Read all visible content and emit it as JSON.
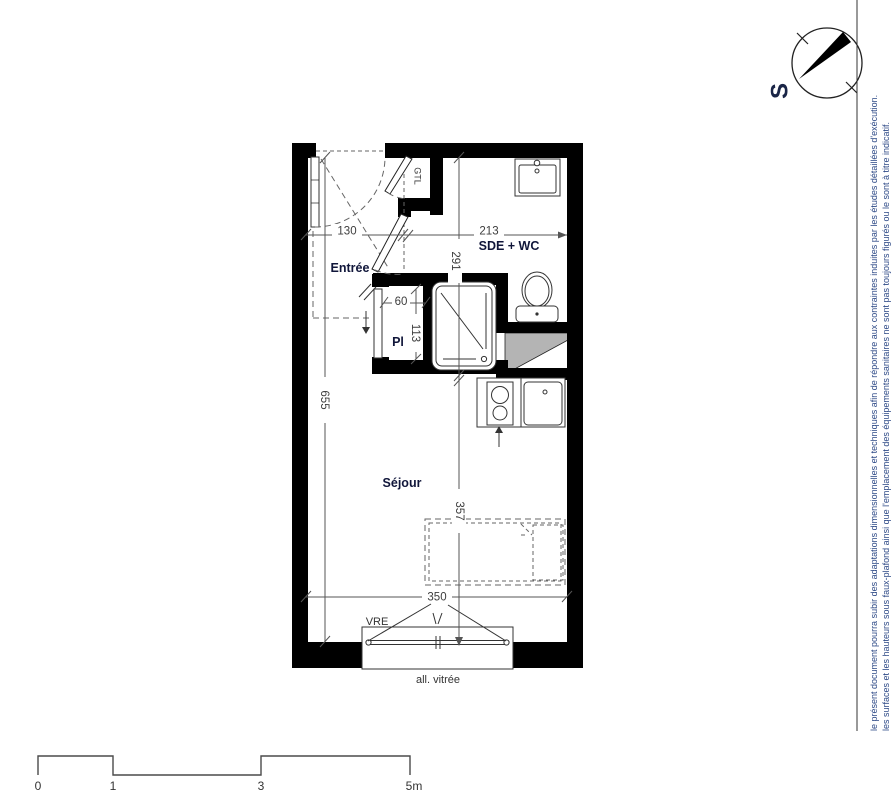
{
  "plan": {
    "rooms": {
      "entree": "Entrée",
      "sde_wc": "SDE + WC",
      "sejour": "Séjour",
      "placard": "Pl",
      "gtl": "GTL"
    },
    "dimensions": {
      "entree_width": "130",
      "sde_width": "213",
      "sde_depth": "291",
      "placard_width": "60",
      "placard_depth": "113",
      "left_height": "655",
      "sejour_depth": "357",
      "window_width": "350"
    },
    "window": {
      "label": "VRE",
      "caption": "all. vitrée"
    }
  },
  "compass": {
    "south_label": "S"
  },
  "side_note": {
    "line1": "le présent document pourra subir des adaptations dimensionnelles et techniques afin de répondre aux contraintes induites par les études détaillées d'exécution.",
    "line2": "les surfaces et les hauteurs sous faux-plafond ainsi que l'emplacement des équipements sanitaires ne sont pas toujours figurés ou le sont à titre indicatif."
  },
  "scale_bar": {
    "t0": "0",
    "t1": "1",
    "t3": "3",
    "t5": "5m"
  },
  "colors": {
    "wall": "#000000",
    "line": "#333333",
    "annotation": "#10163a",
    "side_text": "#2e4a87",
    "duct_shade": "#b4b4b4"
  }
}
